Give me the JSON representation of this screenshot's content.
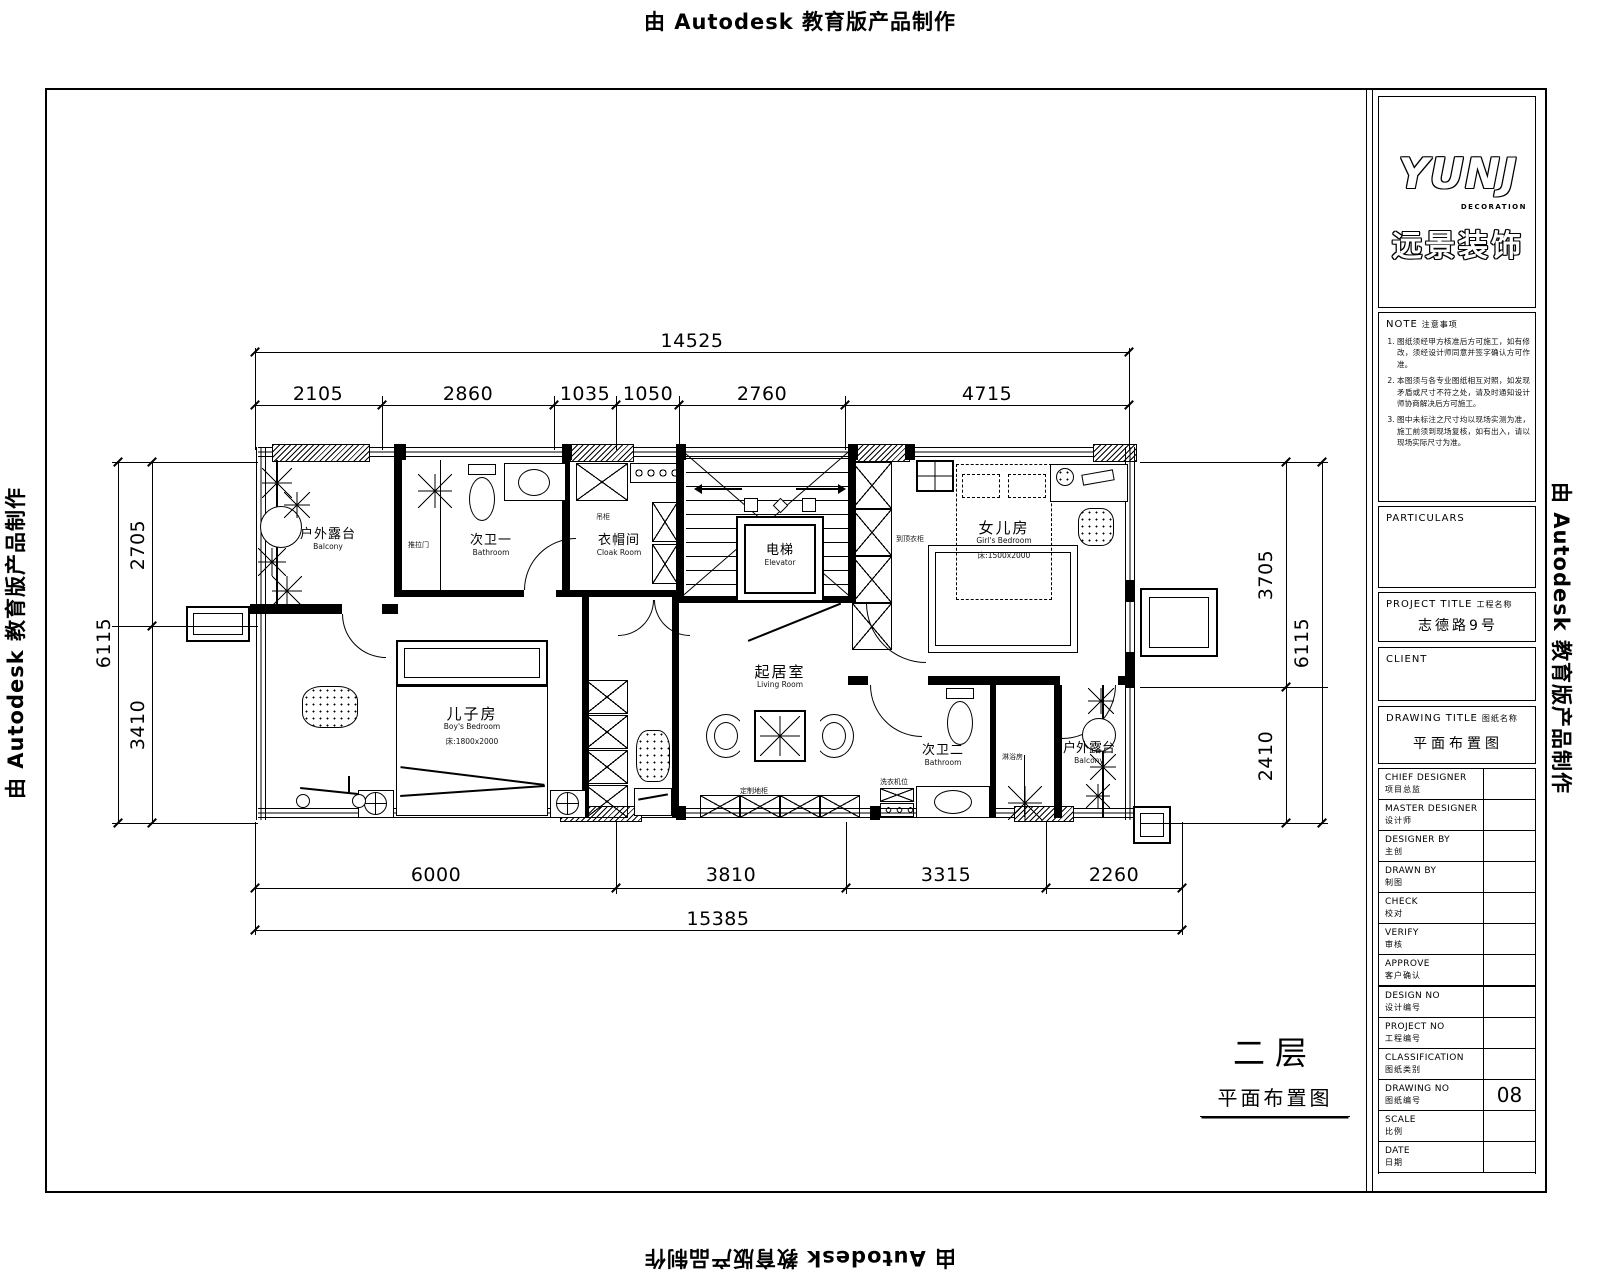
{
  "watermark": {
    "text": "由 Autodesk 教育版产品制作"
  },
  "title_block": {
    "logo": {
      "brand": "YUNJ",
      "tagline": "DECORATION",
      "cn": "远景装饰"
    },
    "note": {
      "title_en": "NOTE",
      "title_cn": "注意事项",
      "items": [
        "图纸须经甲方核准后方可施工，如有修改，须经设计师同意并签字确认方可作准。",
        "本图须与各专业图纸相互对照，如发现矛盾或尺寸不符之处，请及时通知设计师协商解决后方可施工。",
        "图中未标注之尺寸均以现场实测为准，施工前须到现场复核，如有出入，请以现场实际尺寸为准。"
      ]
    },
    "particulars_label": "PARTICULARS",
    "project": {
      "en": "PROJECT  TITLE",
      "cn": "工程名称",
      "value": "志德路9号"
    },
    "client_label": "CLIENT",
    "drawing": {
      "en": "DRAWING  TITLE",
      "cn": "图纸名称",
      "value": "平面布置图"
    },
    "rows": [
      {
        "en": "CHIEF  DESIGNER",
        "cn": "项目总监",
        "value": ""
      },
      {
        "en": "MASTER  DESIGNER",
        "cn": "设计师",
        "value": ""
      },
      {
        "en": "DESIGNER  BY",
        "cn": "主创",
        "value": ""
      },
      {
        "en": "DRAWN  BY",
        "cn": "制图",
        "value": ""
      },
      {
        "en": "CHECK",
        "cn": "校对",
        "value": ""
      },
      {
        "en": "VERIFY",
        "cn": "审核",
        "value": ""
      },
      {
        "en": "APPROVE",
        "cn": "客户确认",
        "value": ""
      },
      {
        "en": "DESIGN  NO",
        "cn": "设计编号",
        "value": ""
      },
      {
        "en": "PROJECT  NO",
        "cn": "工程编号",
        "value": ""
      },
      {
        "en": "CLASSIFICATION",
        "cn": "图纸类别",
        "value": ""
      },
      {
        "en": "DRAWING  NO",
        "cn": "图纸编号",
        "value": "08"
      },
      {
        "en": "SCALE",
        "cn": "比例",
        "value": ""
      },
      {
        "en": "DATE",
        "cn": "日期",
        "value": ""
      }
    ]
  },
  "plan": {
    "rooms": {
      "balcony_tl": {
        "name": "户外露台",
        "sub": "Balcony"
      },
      "bath1": {
        "name": "次卫一",
        "sub": "Bathroom"
      },
      "cloak": {
        "name": "衣帽间",
        "sub": "Cloak Room"
      },
      "elevator": {
        "name": "电梯",
        "sub": "Elevator"
      },
      "girl": {
        "name": "女儿房",
        "sub": "Girl's Bedroom",
        "bed": "床:1500x2000"
      },
      "boy": {
        "name": "儿子房",
        "sub": "Boy's Bedroom",
        "bed": "床:1800x2000"
      },
      "living": {
        "name": "起居室",
        "sub": "Living Room"
      },
      "bath2": {
        "name": "次卫二",
        "sub": "Bathroom"
      },
      "terrace_br": {
        "name": "户外露台",
        "sub": "Balcony"
      }
    },
    "small_labels": {
      "door": "推拉门",
      "cabinet_top": "吊柜",
      "wardrobe": "到顶衣柜",
      "washer": "洗衣机位",
      "shower": "淋浴房",
      "cabinet_low": "定制地柜"
    },
    "dims": {
      "top": {
        "total": "14525",
        "segments": [
          "2105",
          "2860",
          "1035",
          "1050",
          "2760",
          "4715"
        ]
      },
      "bottom": {
        "total": "15385",
        "segments": [
          "6000",
          "3810",
          "3315",
          "2260"
        ]
      },
      "left": {
        "total": "6115",
        "segments": [
          "2705",
          "3410"
        ]
      },
      "right": {
        "total": "6115",
        "segments": [
          "3705",
          "2410"
        ]
      }
    }
  },
  "floor_label": {
    "floor": "二层",
    "title": "平面布置图"
  }
}
